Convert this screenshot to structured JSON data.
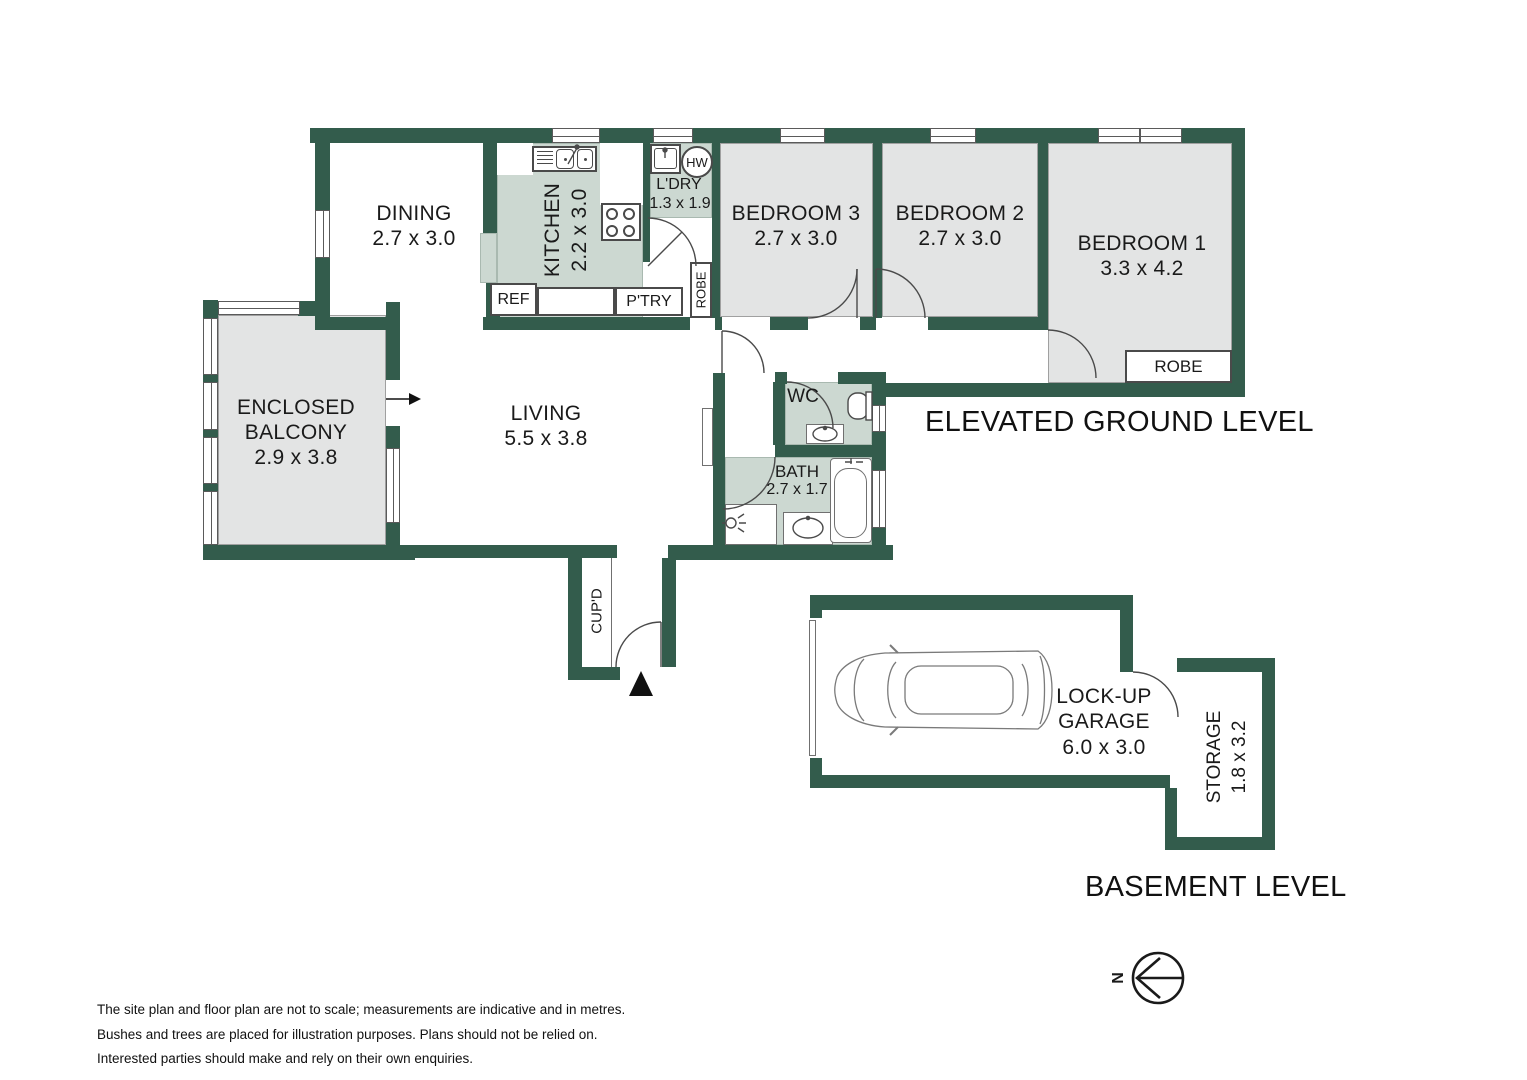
{
  "title_labels": {
    "upper_level": "ELEVATED GROUND LEVEL",
    "lower_level": "BASEMENT LEVEL"
  },
  "rooms": {
    "dining": {
      "name": "DINING",
      "dims": "2.7 x 3.0"
    },
    "kitchen": {
      "name": "KITCHEN",
      "dims": "2.2 x 3.0"
    },
    "laundry": {
      "name": "L'DRY",
      "dims": "1.3 x 1.9"
    },
    "bedroom3": {
      "name": "BEDROOM 3",
      "dims": "2.7 x 3.0"
    },
    "bedroom2": {
      "name": "BEDROOM 2",
      "dims": "2.7 x 3.0"
    },
    "bedroom1": {
      "name": "BEDROOM 1",
      "dims": "3.3 x 4.2"
    },
    "balcony": {
      "line1": "ENCLOSED",
      "line2": "BALCONY",
      "dims": "2.9 x 3.8"
    },
    "living": {
      "name": "LIVING",
      "dims": "5.5 x 3.8"
    },
    "wc": {
      "name": "WC"
    },
    "bath": {
      "name": "BATH",
      "dims": "2.7 x 1.7"
    },
    "garage": {
      "line1": "LOCK-UP",
      "line2": "GARAGE",
      "dims": "6.0 x 3.0"
    },
    "storage": {
      "name": "STORAGE",
      "dims": "1.8 x 3.2"
    },
    "cupboard": {
      "name": "CUP'D"
    }
  },
  "fixtures": {
    "fridge": "REF",
    "pantry": "P'TRY",
    "hot_water": "HW",
    "hall_robe": "ROBE",
    "bedroom1_robe": "ROBE"
  },
  "compass": {
    "north": "N"
  },
  "disclaimer": [
    "The site plan and floor plan are not to scale; measurements are indicative and in metres.",
    "Bushes and trees are placed for illustration purposes. Plans should not be relied on.",
    "Interested parties should make and rely on their own enquiries."
  ],
  "colors": {
    "wall": "#335c4c",
    "wet_area_floor": "#ccd8d1",
    "room_floor": "#e3e4e4",
    "line": "#4a4a4a"
  }
}
